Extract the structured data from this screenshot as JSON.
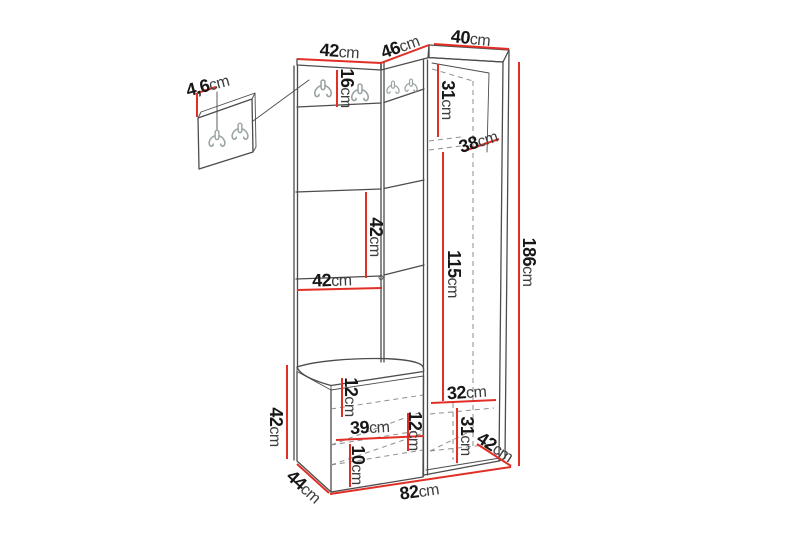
{
  "palette": {
    "background": "#ffffff",
    "dimension_red": "#e12f27",
    "structure_line": "#4c4c4c",
    "dashed_line": "#8e8e8e",
    "hook_gray": "#9aa3a3",
    "number_color": "#171717",
    "unit_color": "#3d3d3d"
  },
  "icons": {
    "coat_hook": "double-coat-hook"
  },
  "dimensions": {
    "wall_panel_thickness": {
      "value": "4,6",
      "unit": "cm"
    },
    "top_width_left": {
      "value": "42",
      "unit": "cm"
    },
    "top_width_middle": {
      "value": "46",
      "unit": "cm"
    },
    "top_width_right": {
      "value": "40",
      "unit": "cm"
    },
    "hook_strip_height": {
      "value": "16",
      "unit": "cm"
    },
    "wardrobe_top_section_height": {
      "value": "31",
      "unit": "cm"
    },
    "wardrobe_upper_depth": {
      "value": "38",
      "unit": "cm"
    },
    "mid_section_height": {
      "value": "42",
      "unit": "cm"
    },
    "panel_width": {
      "value": "42",
      "unit": "cm"
    },
    "wardrobe_interior_height": {
      "value": "115",
      "unit": "cm"
    },
    "total_height": {
      "value": "186",
      "unit": "cm"
    },
    "seat_section_height": {
      "value": "12",
      "unit": "cm"
    },
    "bench_interior_width": {
      "value": "39",
      "unit": "cm"
    },
    "bench_mid_section_height": {
      "value": "12",
      "unit": "cm"
    },
    "bench_bottom_section_height": {
      "value": "10",
      "unit": "cm"
    },
    "bench_height": {
      "value": "42",
      "unit": "cm"
    },
    "bench_depth": {
      "value": "44",
      "unit": "cm"
    },
    "total_width": {
      "value": "82",
      "unit": "cm"
    },
    "wardrobe_bottom_interior_width": {
      "value": "32",
      "unit": "cm"
    },
    "wardrobe_bottom_section_height": {
      "value": "31",
      "unit": "cm"
    },
    "wardrobe_bottom_depth": {
      "value": "42",
      "unit": "cm"
    }
  }
}
